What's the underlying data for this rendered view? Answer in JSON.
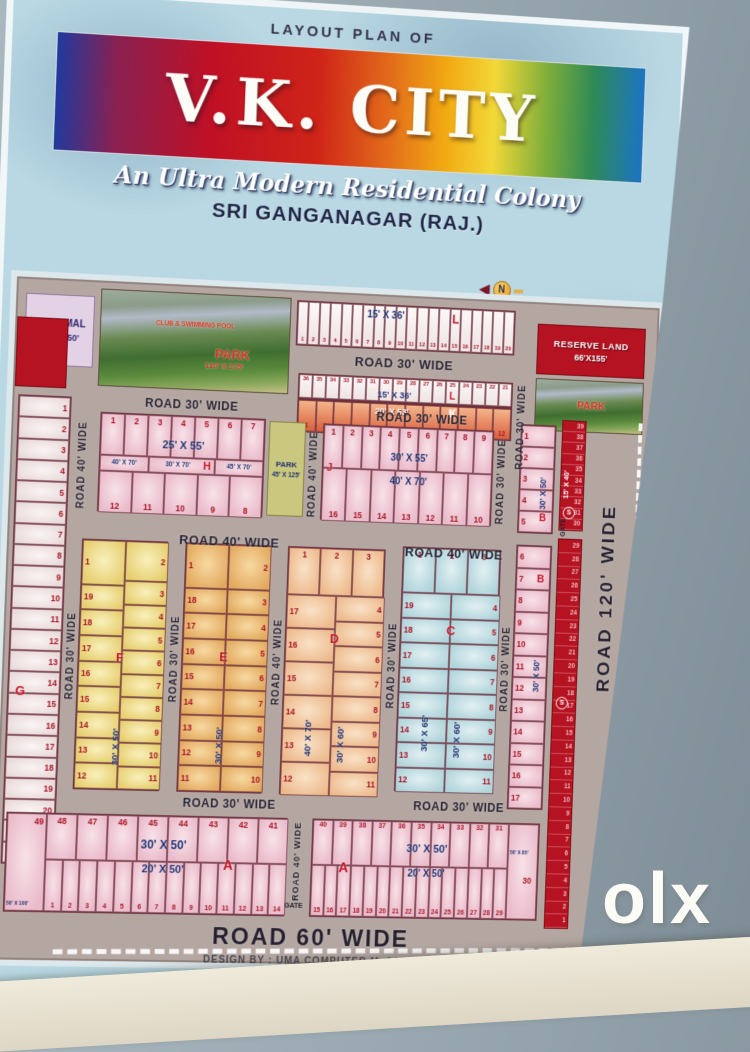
{
  "header": {
    "kicker": "LAYOUT PLAN OF",
    "title": "V.K. CITY",
    "subtitle": "An Ultra Modern Residential Colony",
    "city": "SRI GANGANAGAR (RAJ.)",
    "north": "N"
  },
  "footer": {
    "credit": "DESIGN BY : UMA COMPUTER M. 94149-65455"
  },
  "photo": {
    "watermark": "olx",
    "watermark_sub": "INDIA"
  },
  "roads": {
    "r30": "ROAD 30' WIDE",
    "r40": "ROAD 40' WIDE",
    "r60": "ROAD 60' WIDE",
    "r120": "ROAD 120' WIDE",
    "gate": "GATE"
  },
  "colors": {
    "sheet": "#b9d8e3",
    "road_bg": "#b4a7a2",
    "red_block": "#b51322",
    "pink": "#eec2cc",
    "yellow": "#ecd977",
    "orange": "#edbd72",
    "peach": "#f3cfa8",
    "cyan": "#c2dfe2",
    "olive": "#c9c87e",
    "lavender": "#e0cfe4"
  },
  "blocks": {
    "informal": {
      "line1": "INFORMAL",
      "line2": "90' X 150'"
    },
    "park_main": {
      "top": "CLUB & SWIMMING POOL",
      "name": "PARK",
      "dim": "110' X 175'"
    },
    "reserve": {
      "line1": "RESERVE LAND",
      "line2": "66'X155'"
    },
    "park_right": {
      "name": "PARK"
    },
    "park_h": {
      "name": "PARK",
      "dim": "45' X 125'"
    },
    "strip_l1": {
      "dim": "15' X 36'",
      "letter": "L",
      "numbers": [
        1,
        2,
        3,
        4,
        5,
        6,
        7,
        8,
        9,
        10,
        11,
        12,
        13,
        14,
        15,
        16,
        17,
        18,
        19,
        20
      ]
    },
    "strip_l2": {
      "dim": "15' X 36'",
      "letter": "L",
      "numbers": [
        36,
        35,
        34,
        33,
        32,
        31,
        30,
        29,
        28,
        27,
        26,
        25,
        24,
        23,
        22,
        21
      ]
    },
    "strip_k": {
      "dim": "20' X 53'",
      "letter": "K",
      "numbers": [
        1,
        2,
        3,
        4,
        5,
        6,
        7,
        8,
        9,
        10,
        11,
        12
      ]
    },
    "h": {
      "letter": "H",
      "dim_top": "25' X 55'",
      "dims_mid": [
        "40' X 70'",
        "30' X 70'",
        "45' X 70'"
      ],
      "top": [
        1,
        2,
        3,
        4,
        5,
        6,
        7
      ],
      "bottom": [
        12,
        11,
        10,
        9,
        8
      ]
    },
    "j": {
      "letter": "J",
      "dim_top": "30' X 55'",
      "dim_bottom": "40' X 70'",
      "top": [
        1,
        2,
        3,
        4,
        5,
        6,
        7,
        8,
        9
      ],
      "bottom": [
        16,
        15,
        14,
        13,
        12,
        11,
        10
      ]
    },
    "g": {
      "letter": "G",
      "numbers": [
        1,
        2,
        3,
        4,
        5,
        6,
        7,
        8,
        9,
        10,
        11,
        12,
        13,
        14,
        15,
        16,
        17,
        18,
        19,
        20,
        21,
        22
      ]
    },
    "f": {
      "letter": "F",
      "dim": "30' X 50'",
      "left": [
        1,
        19,
        18,
        17,
        16,
        15,
        14,
        13,
        12
      ],
      "right": [
        2,
        3,
        4,
        5,
        6,
        7,
        8,
        9,
        10,
        11
      ]
    },
    "e": {
      "letter": "E",
      "dim": "30' X 50'",
      "left": [
        1,
        18,
        17,
        16,
        15,
        14,
        13,
        12,
        11
      ],
      "right": [
        2,
        3,
        4,
        5,
        6,
        7,
        8,
        9,
        10
      ]
    },
    "d": {
      "letter": "D",
      "dim_left": "40' X 70'",
      "dim_right": "30' X 60'",
      "top": [
        1,
        2,
        3
      ],
      "left": [
        17,
        16,
        15,
        14,
        13,
        12
      ],
      "right": [
        4,
        5,
        6,
        7,
        8,
        9,
        10,
        11
      ]
    },
    "c": {
      "letter": "C",
      "dim_left": "30' X 65'",
      "dim_right": "30' X 60'",
      "top": [
        1,
        2,
        3
      ],
      "left": [
        19,
        18,
        17,
        16,
        15,
        14,
        13,
        12
      ],
      "right": [
        4,
        5,
        6,
        7,
        8,
        9,
        10,
        11
      ]
    },
    "b_top": {
      "letter": "B",
      "dim": "30' X 50'",
      "numbers": [
        1,
        2,
        3,
        4,
        5
      ]
    },
    "b_low": {
      "letter": "B",
      "dim": "30' X 50'",
      "numbers": [
        6,
        7,
        8,
        9,
        10,
        11,
        12,
        13,
        14,
        15,
        16,
        17
      ]
    },
    "s_top": {
      "letter": "S",
      "dim": "15' X 40'",
      "numbers": [
        39,
        38,
        37,
        36,
        35,
        34,
        33,
        32,
        31,
        30
      ]
    },
    "s_low": {
      "letter": "S",
      "numbers": [
        29,
        28,
        27,
        26,
        25,
        24,
        23,
        22,
        21,
        20,
        19,
        18,
        17,
        16,
        15,
        14,
        13,
        12,
        11,
        10,
        9,
        8,
        7,
        6,
        5,
        4,
        3,
        2,
        1
      ]
    },
    "a_left": {
      "letter": "A",
      "dim_top": "30' X 50'",
      "dim_bottom": "20' X 50'",
      "corner": "49",
      "corner_dim": "50' X 100'",
      "top": [
        48,
        47,
        46,
        45,
        44,
        43,
        42,
        41
      ],
      "bottom": [
        1,
        2,
        3,
        4,
        5,
        6,
        7,
        8,
        9,
        10,
        11,
        12,
        13,
        14
      ]
    },
    "a_right": {
      "letter": "A",
      "dim_top": "30' X 50'",
      "dim_bottom": "20' X 50'",
      "corner": "30",
      "corner_dim": "50' X 85'",
      "top": [
        40,
        39,
        38,
        37,
        36,
        35,
        34,
        33,
        32,
        31
      ],
      "bottom": [
        15,
        16,
        17,
        18,
        19,
        20,
        21,
        22,
        23,
        24,
        25,
        26,
        27,
        28,
        29
      ]
    }
  }
}
